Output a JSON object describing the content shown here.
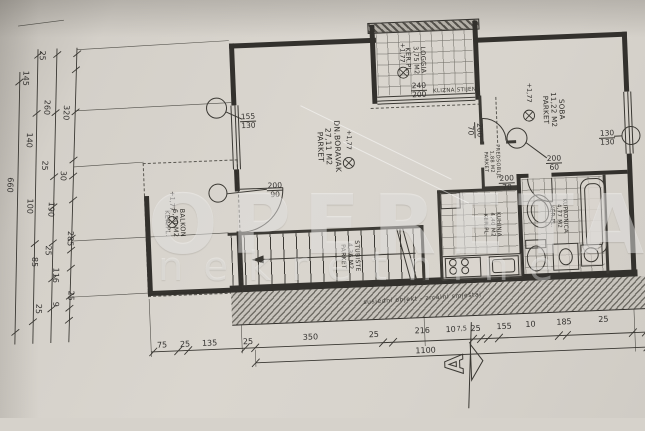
{
  "watermark": {
    "primary": "OPERETA",
    "secondary": "nekretnine"
  },
  "rooms": [
    {
      "name": "DN.BORAVAK",
      "area": "27,11 M2",
      "floor": "PARKET"
    },
    {
      "name": "SOBA",
      "area": "11,22 M2",
      "floor": "PARKET"
    },
    {
      "name": "LOGGIA",
      "area": "3,75 M2",
      "floor": "KER.PL."
    },
    {
      "name": "BALKON",
      "area": "6,50 M2",
      "floor": "KER.PL."
    },
    {
      "name": "KUHINJA",
      "area": "4,40 M2",
      "floor": "KER.PL."
    },
    {
      "name": "KUPAONICA",
      "area": "4,77 M2",
      "floor": "KER.PL."
    },
    {
      "name": "PREDSOBLJE",
      "area": "1,88 M2",
      "floor": "PARKET"
    },
    {
      "name": "STUBIŠTE",
      "area": "4,36 M2",
      "floor": "PARKET"
    }
  ],
  "level_mark": "+1,77",
  "openings": {
    "left_window": {
      "w": "155",
      "h": "130"
    },
    "balcony_door": {
      "w": "200",
      "h": "90"
    },
    "loggia_wall": {
      "w": "240",
      "h": "200"
    },
    "loggia_wall_note": "KLIZNA STIJENA",
    "room_door": {
      "w": "200",
      "h": "60"
    },
    "right_window": {
      "w": "130",
      "h": "130"
    },
    "bath_door": {
      "w": "200",
      "h": "70"
    },
    "hall_door": {
      "w": "200",
      "h": "70"
    }
  },
  "neighbor_note": "susjedni objekt - zrcalni smještaj",
  "section_label": "A",
  "dims": {
    "left": [
      "25",
      "145",
      "260",
      "320",
      "140",
      "25",
      "30",
      "660",
      "100",
      "190",
      "285",
      "25",
      "85",
      "116",
      "25",
      "9",
      "25"
    ],
    "bottom": [
      "75",
      "25",
      "135",
      "25",
      "350",
      "25",
      "216",
      "10",
      "7,5",
      "25",
      "155",
      "10",
      "185",
      "25"
    ],
    "total": "1100"
  }
}
